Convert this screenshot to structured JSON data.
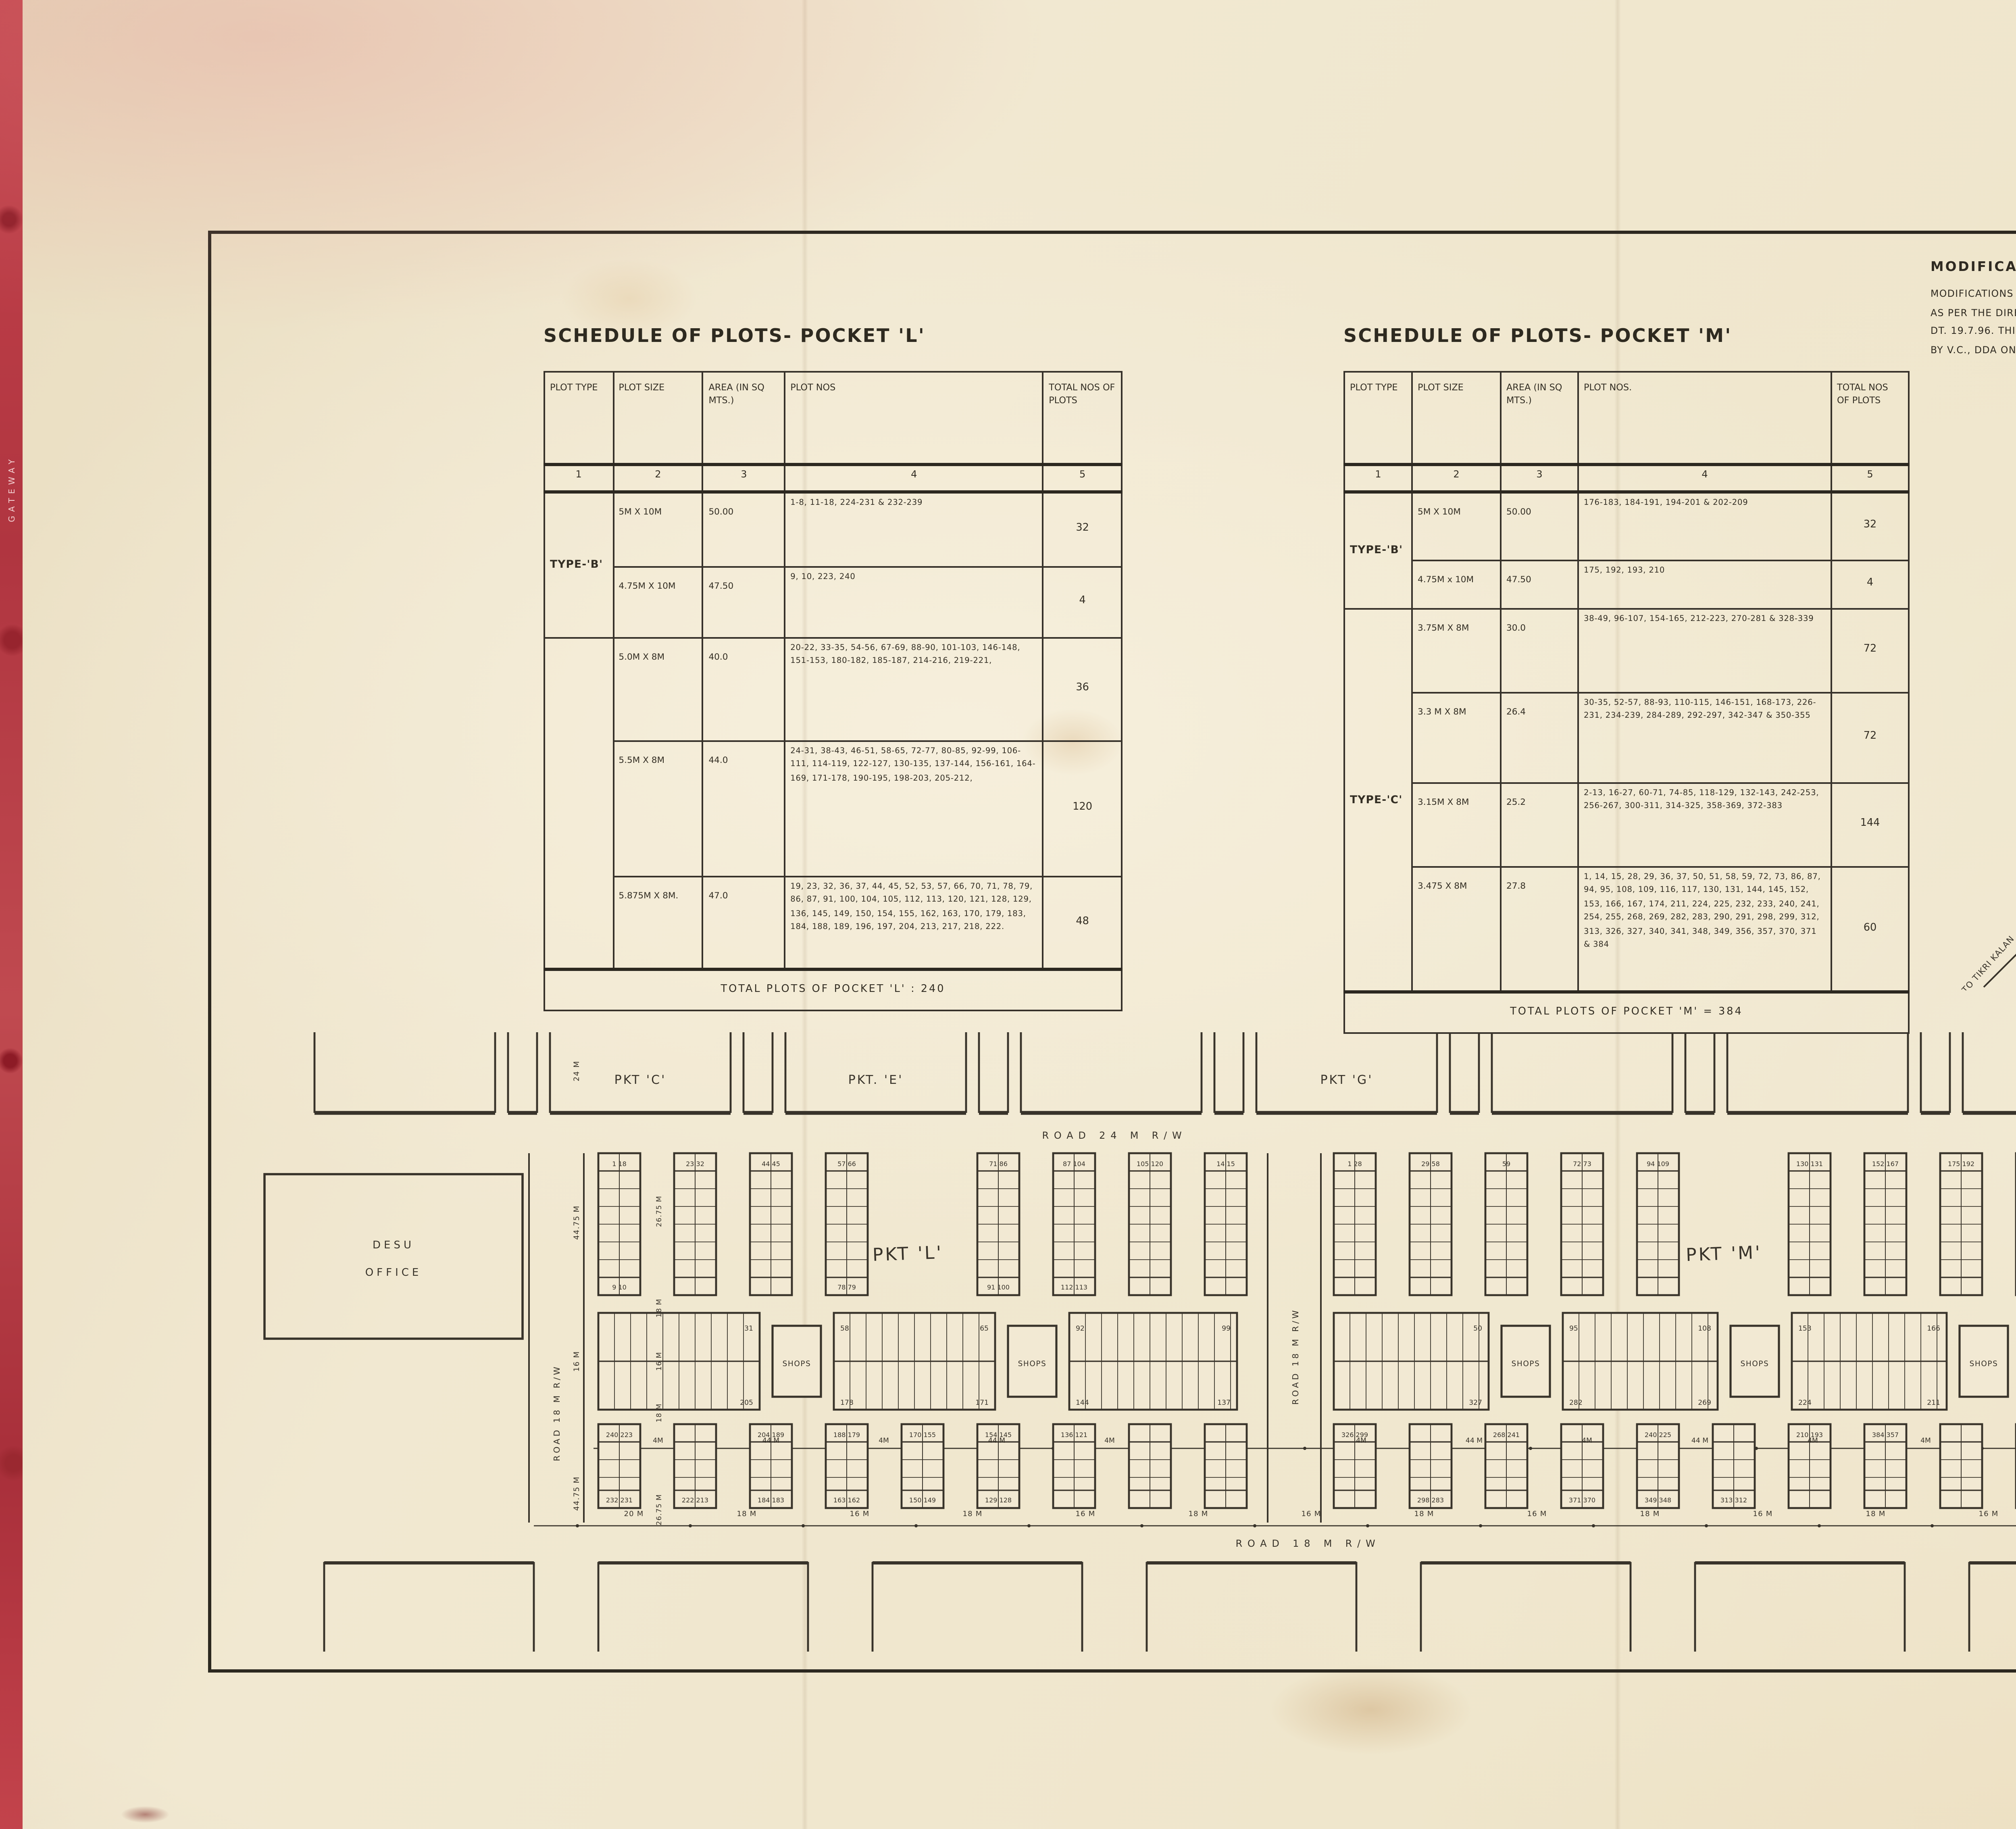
{
  "sheet": {
    "left_edge_label": "GATEWAY",
    "authority": {
      "name_line1": "DELHI DEVELOPMENT",
      "name_line2": "AUTHORITY",
      "name_hindi": "दिल्ली विकास प्राधिकरण"
    },
    "modifications": {
      "heading": "MODIFICATIONS:",
      "lines": [
        "MODIFICATIONS IN THE PLOT SIZES HAS BEEN CARRIED OUT",
        "AS PER THE DIRECTIONS OF L.G. DT. 20.6.96 AND V.C., DDA",
        "DT. 19.7.96.    THIS MODIFIED PLAN HAS BEEN APPROVED",
        "BY V.C., DDA ON 2.8.96 ON FILE F 100(35)96/CL/PT."
      ]
    },
    "note": {
      "heading": "NOTE_",
      "date_label": "DT._",
      "date_value": "1ST. AUGUST/1996.",
      "items": [
        "CONVERSION OF 'C' CATEGORY PLOTS (PKT-L) OF 25 SQM. TO 40 SQM, 44 SQM AND 48 SQM. HAS BEEN MADE AS PER THE DIRECTION OF L.G./DDA. VIDE ORDER DT.-26.6.96. AND SUBSEQUENT ORDER OF V.C. D.D.A. DT.-19.7.96. IN FILE - F 100(35)96/CL/PT.",
        "THIS PLAN IS TO BE READ WITH DRG. NO PVC/LP/1 (SHEET NO 291.)",
        "THIS DIMENSION PLAN IS TO BASED ON THE FEASIBILITY REPORT RECEIVED FROM EE NO V DDA VIDE LETTER NO EE. ND.5/SPL. MESSENGER/1, DT.-22.11.95.",
        "ALL DIMENSIONS ARE IN METRES.",
        "EXACT PLOT SIZE/AREA IS SUBJECT TO PLOT DEMARCATION AT SITE.",
        "ANY DISCRIPENCY, TO BE BROUGHT TO THE NOTICE OF DIR.(PLG.) N.P.",
        "FOR TYPICAL DESIGN FOR PLOTS REFER DRG. PVC/UT/1 (SHEET NO 290)",
        "THESE PLOTS ARE FEASIBLE AS PER THE FEASIBILITY REPORT RECEIVED FROM EE/ND.5/DDA, VIDE LETTER NO F4(227), EE/ND.5/DDA/943, DT. 8.8.96."
      ]
    },
    "title_block": {
      "modified": "(MODIFIED)",
      "title_lines": [
        "DIMENSION PLAN OF POCKET 'L' & 'M'",
        "PROPOSED P.V.C. BAZAR TIKRI KALAN",
        "ROHTAK ROAD"
      ],
      "scale_label": "scale",
      "scale_hindi": "माप",
      "date_label": "date",
      "date_hindi": "दिनांक",
      "date_value": "1ST. AUGUST/1996.",
      "north_label": "north",
      "north_hindi": "उत्तर",
      "north_symbol": "N",
      "dealt_by_label": "dealt by",
      "dealt_by_hindi": "बनाया",
      "dealt_by_value_1": "A.K. VASHIST",
      "dealt_by_value_2": "SHYAM SUNDER",
      "asstt_dir_label": "asstt dir",
      "asstt_dir_hindi": "सहायक निर्देशक",
      "dy_director_label": "dy. director",
      "dy_director_hindi": "उप निर्देशक",
      "project_planner_label": "project planner",
      "project_planner_hindi": "परियोजना नियोजक",
      "drawing_no_label": "drawing no",
      "drawing_no_hindi": "ड्राईंग सं.",
      "drawing_no_value": "LP/L-M/8",
      "drawing_no_note": "(MODIFIED)",
      "project_name": "NARELA PROJECT",
      "project_name_hindi": "नरेला परियोजना",
      "sheet_no_label": "SHEET NO.",
      "sheet_no_value": "331",
      "sheet_no_note": "(MODIFIED)"
    }
  },
  "schedule_l": {
    "title": "SCHEDULE OF PLOTS- POCKET 'L'",
    "col_headers": [
      "PLOT TYPE",
      "PLOT SIZE",
      "AREA (IN SQ MTS.)",
      "PLOT NOS",
      "TOTAL NOS OF PLOTS"
    ],
    "col_nums": [
      "1",
      "2",
      "3",
      "4",
      "5"
    ],
    "type_b": "TYPE-'B'",
    "type_rest": "",
    "rows": [
      {
        "size": "5M X 10M",
        "area": "50.00",
        "nos": "1-8, 11-18, 224-231 & 232-239",
        "total": "32"
      },
      {
        "size": "4.75M X 10M",
        "area": "47.50",
        "nos": "9, 10, 223, 240",
        "total": "4"
      },
      {
        "size": "5.0M X 8M",
        "area": "40.0",
        "nos": "20-22, 33-35, 54-56, 67-69, 88-90, 101-103, 146-148, 151-153, 180-182, 185-187, 214-216, 219-221,",
        "total": "36"
      },
      {
        "size": "5.5M X 8M",
        "area": "44.0",
        "nos": "24-31, 38-43, 46-51, 58-65, 72-77, 80-85, 92-99, 106-111, 114-119, 122-127, 130-135, 137-144, 156-161, 164-169, 171-178, 190-195, 198-203, 205-212,",
        "total": "120"
      },
      {
        "size": "5.875M X 8M.",
        "area": "47.0",
        "nos": "19, 23, 32, 36, 37, 44, 45, 52, 53, 57, 66, 70, 71, 78, 79, 86, 87, 91, 100, 104, 105, 112, 113, 120, 121, 128, 129, 136, 145, 149, 150, 154, 155, 162, 163, 170, 179, 183, 184, 188, 189, 196, 197, 204, 213, 217, 218, 222.",
        "total": "48"
      }
    ],
    "footer": "TOTAL PLOTS OF POCKET 'L' : 240"
  },
  "schedule_m": {
    "title": "SCHEDULE OF PLOTS- POCKET 'M'",
    "col_headers": [
      "PLOT TYPE",
      "PLOT SIZE",
      "AREA (IN SQ MTS.)",
      "PLOT NOS.",
      "TOTAL NOS OF PLOTS"
    ],
    "col_nums": [
      "1",
      "2",
      "3",
      "4",
      "5"
    ],
    "type_b": "TYPE-'B'",
    "type_c": "TYPE-'C'",
    "rows": [
      {
        "size": "5M X 10M",
        "area": "50.00",
        "nos": "176-183, 184-191, 194-201 & 202-209",
        "total": "32"
      },
      {
        "size": "4.75M x 10M",
        "area": "47.50",
        "nos": "175, 192, 193, 210",
        "total": "4"
      },
      {
        "size": "3.75M X 8M",
        "area": "30.0",
        "nos": "38-49, 96-107, 154-165, 212-223, 270-281 & 328-339",
        "total": "72"
      },
      {
        "size": "3.3 M X 8M",
        "area": "26.4",
        "nos": "30-35, 52-57, 88-93, 110-115, 146-151, 168-173, 226-231, 234-239, 284-289, 292-297, 342-347 & 350-355",
        "total": "72"
      },
      {
        "size": "3.15M X 8M",
        "area": "25.2",
        "nos": "2-13, 16-27, 60-71, 74-85, 118-129, 132-143, 242-253, 256-267, 300-311, 314-325, 358-369, 372-383",
        "total": "144"
      },
      {
        "size": "3.475 X 8M",
        "area": "27.8",
        "nos": "1, 14, 15, 28, 29, 36, 37, 50, 51, 58, 59, 72, 73, 86, 87, 94, 95, 108, 109, 116, 117, 130, 131, 144, 145, 152, 153, 166, 167, 174, 211, 224, 225, 232, 233, 240, 241, 254, 255, 268, 269, 282, 283, 290, 291, 298, 299, 312, 313, 326, 327, 340, 341, 348, 349, 356, 357, 370, 371 & 384",
        "total": "60"
      }
    ],
    "footer": "TOTAL PLOTS OF POCKET 'M' = 384"
  },
  "key_plan": {
    "title": "KEY PLAN",
    "to_rohtak": "TO ROHTAK ROAD",
    "to_tikri": "TO TIKRI KALAN",
    "labels": {
      "a": "A",
      "c": "C",
      "e": "E",
      "g": "G",
      "i": "I",
      "l": "L",
      "m": "M",
      "n": "N"
    }
  },
  "plan": {
    "road_top": "ROAD  24 M  R/W",
    "road_bottom": "ROAD  18 M  R/W",
    "road_left": "ROAD 18 M R/W",
    "road_center": "ROAD 18 M R/W",
    "road_right": "ROAD 24 M R/W",
    "top_pocket_labels": [
      "PKT 'C'",
      "PKT. 'E'",
      "PKT 'G'",
      "PKT 'I'"
    ],
    "pocket_l": "PKT 'L'",
    "pocket_m": "PKT 'M'",
    "desu_office": [
      "DESU",
      "OFFICE"
    ],
    "shops_label": "SHOPS",
    "left_dims": [
      "24 M",
      "44.75 M",
      "16 M",
      "44.75 M"
    ],
    "inner_dims": [
      "26.75 M",
      "18 M",
      "16 M",
      "18 M",
      "26.75 M"
    ],
    "mid_dim_labels": [
      "4M",
      "44 M",
      "4M",
      "44 M",
      "4M",
      "4M",
      "44 M",
      "4M",
      "44 M",
      "4M",
      "4M",
      "44 M"
    ],
    "bottom_dim_labels": [
      "20 M",
      "18 M",
      "16 M",
      "18 M",
      "16 M",
      "18 M",
      "16 M",
      "18 M",
      "16 M",
      "18 M",
      "16 M",
      "18 M",
      "16 M",
      "18 M",
      "16 M",
      "18 M",
      "24 M"
    ],
    "l_upper_strips": [
      [
        "1 18",
        "9 10"
      ],
      [
        "23 32",
        ""
      ],
      [
        "44 45",
        ""
      ],
      [
        "57 66",
        "78 79"
      ],
      [
        "",
        ""
      ],
      [
        "71 86",
        "91 100"
      ],
      [
        "87 104",
        "112 113"
      ],
      [
        "105 120",
        ""
      ],
      [
        "14 15",
        ""
      ]
    ],
    "l_lower_strips": [
      [
        "240 223",
        "232 231"
      ],
      [
        "",
        "222 213"
      ],
      [
        "204 189",
        "184 183"
      ],
      [
        "188 179",
        "163 162"
      ],
      [
        "170 155",
        "150 149"
      ],
      [
        "154 145",
        "129 128"
      ],
      [
        "136 121",
        ""
      ],
      [
        "",
        ""
      ],
      [
        "",
        ""
      ]
    ],
    "m_upper_strips": [
      [
        "1 28",
        ""
      ],
      [
        "29 58",
        ""
      ],
      [
        "59",
        ""
      ],
      [
        "72 73",
        ""
      ],
      [
        "94 109",
        ""
      ],
      [
        "",
        ""
      ],
      [
        "130 131",
        ""
      ],
      [
        "152 167",
        ""
      ],
      [
        "175 192",
        ""
      ],
      [
        "",
        ""
      ]
    ],
    "m_lower_strips": [
      [
        "326 299",
        ""
      ],
      [
        "",
        "298 283"
      ],
      [
        "268 241",
        ""
      ],
      [
        "",
        "371 370"
      ],
      [
        "240 225",
        "349 348"
      ],
      [
        "",
        "313 312"
      ],
      [
        "210 193",
        ""
      ],
      [
        "384 357",
        ""
      ],
      [
        "",
        ""
      ],
      [
        "",
        ""
      ]
    ],
    "r_upper_strips": [
      [
        "",
        ""
      ],
      [
        "",
        ""
      ],
      [
        "",
        ""
      ]
    ],
    "r_lower_strips": [
      [
        "",
        ""
      ],
      [
        "",
        ""
      ],
      [
        "",
        ""
      ]
    ],
    "l_hstrips": [
      [
        "",
        "31",
        "",
        "205"
      ],
      [
        "58",
        "65",
        "178",
        "171"
      ],
      [
        "92",
        "99",
        "144",
        "137"
      ]
    ],
    "m_hstrips": [
      [
        "",
        "50",
        "",
        "327"
      ],
      [
        "95",
        "108",
        "282",
        "269"
      ],
      [
        "153",
        "166",
        "224",
        "211"
      ]
    ]
  }
}
